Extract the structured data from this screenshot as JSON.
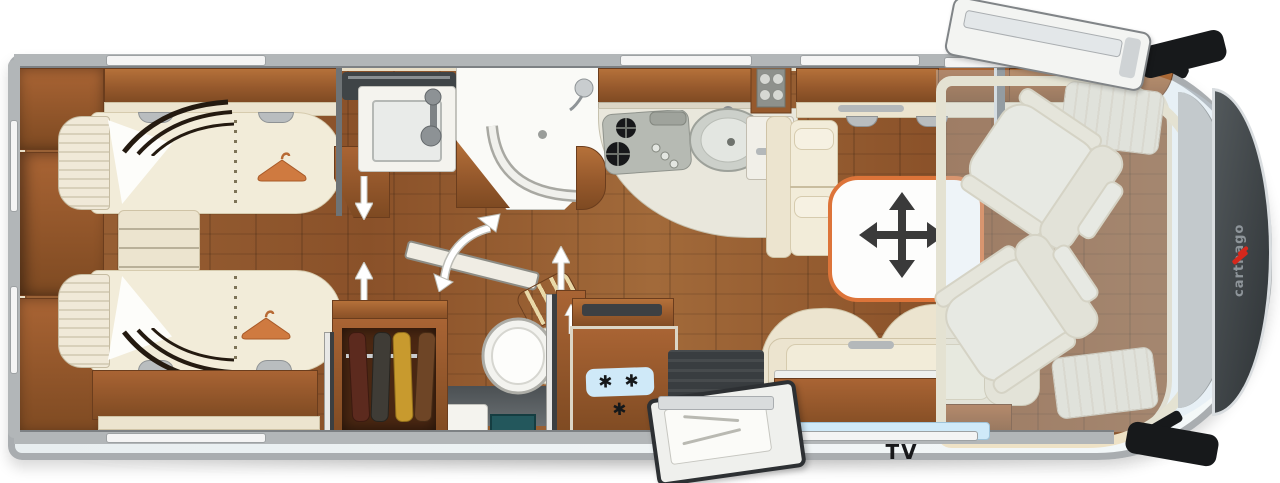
{
  "title": "Motorhome floor plan (top view)",
  "labels": {
    "tv": "TV",
    "brand": "carthago"
  },
  "fridge": {
    "snowflakes": "✱ ✱ ✱"
  },
  "icons": {
    "hanger": "clothes-hanger-icon",
    "table_move": "four-way-move-arrow-icon",
    "slide_arrow": "slide-direction-arrow-icon",
    "door_swing": "door-swing-arrow-icon",
    "snowflake": "✱"
  },
  "colors": {
    "accent_orange": "#dd7439",
    "furniture_wood": "#a35c2c",
    "floor_wood": "#8a5129",
    "upholstery_cream": "#ece4cf",
    "window_blue": "#cfe9f8",
    "wall_gray": "#b2b6b8",
    "dark_gray": "#393d40",
    "brand_red": "#d6281c"
  },
  "areas": {
    "rear_bedroom": "twin single beds",
    "bathroom": "washbasin and shower",
    "toilet_room": "toilet and wardrobe",
    "kitchen": "hob, sink, heater and fridge",
    "dinette": "lounge with lift table and TV sideboard",
    "cab": "two swivel seats"
  }
}
